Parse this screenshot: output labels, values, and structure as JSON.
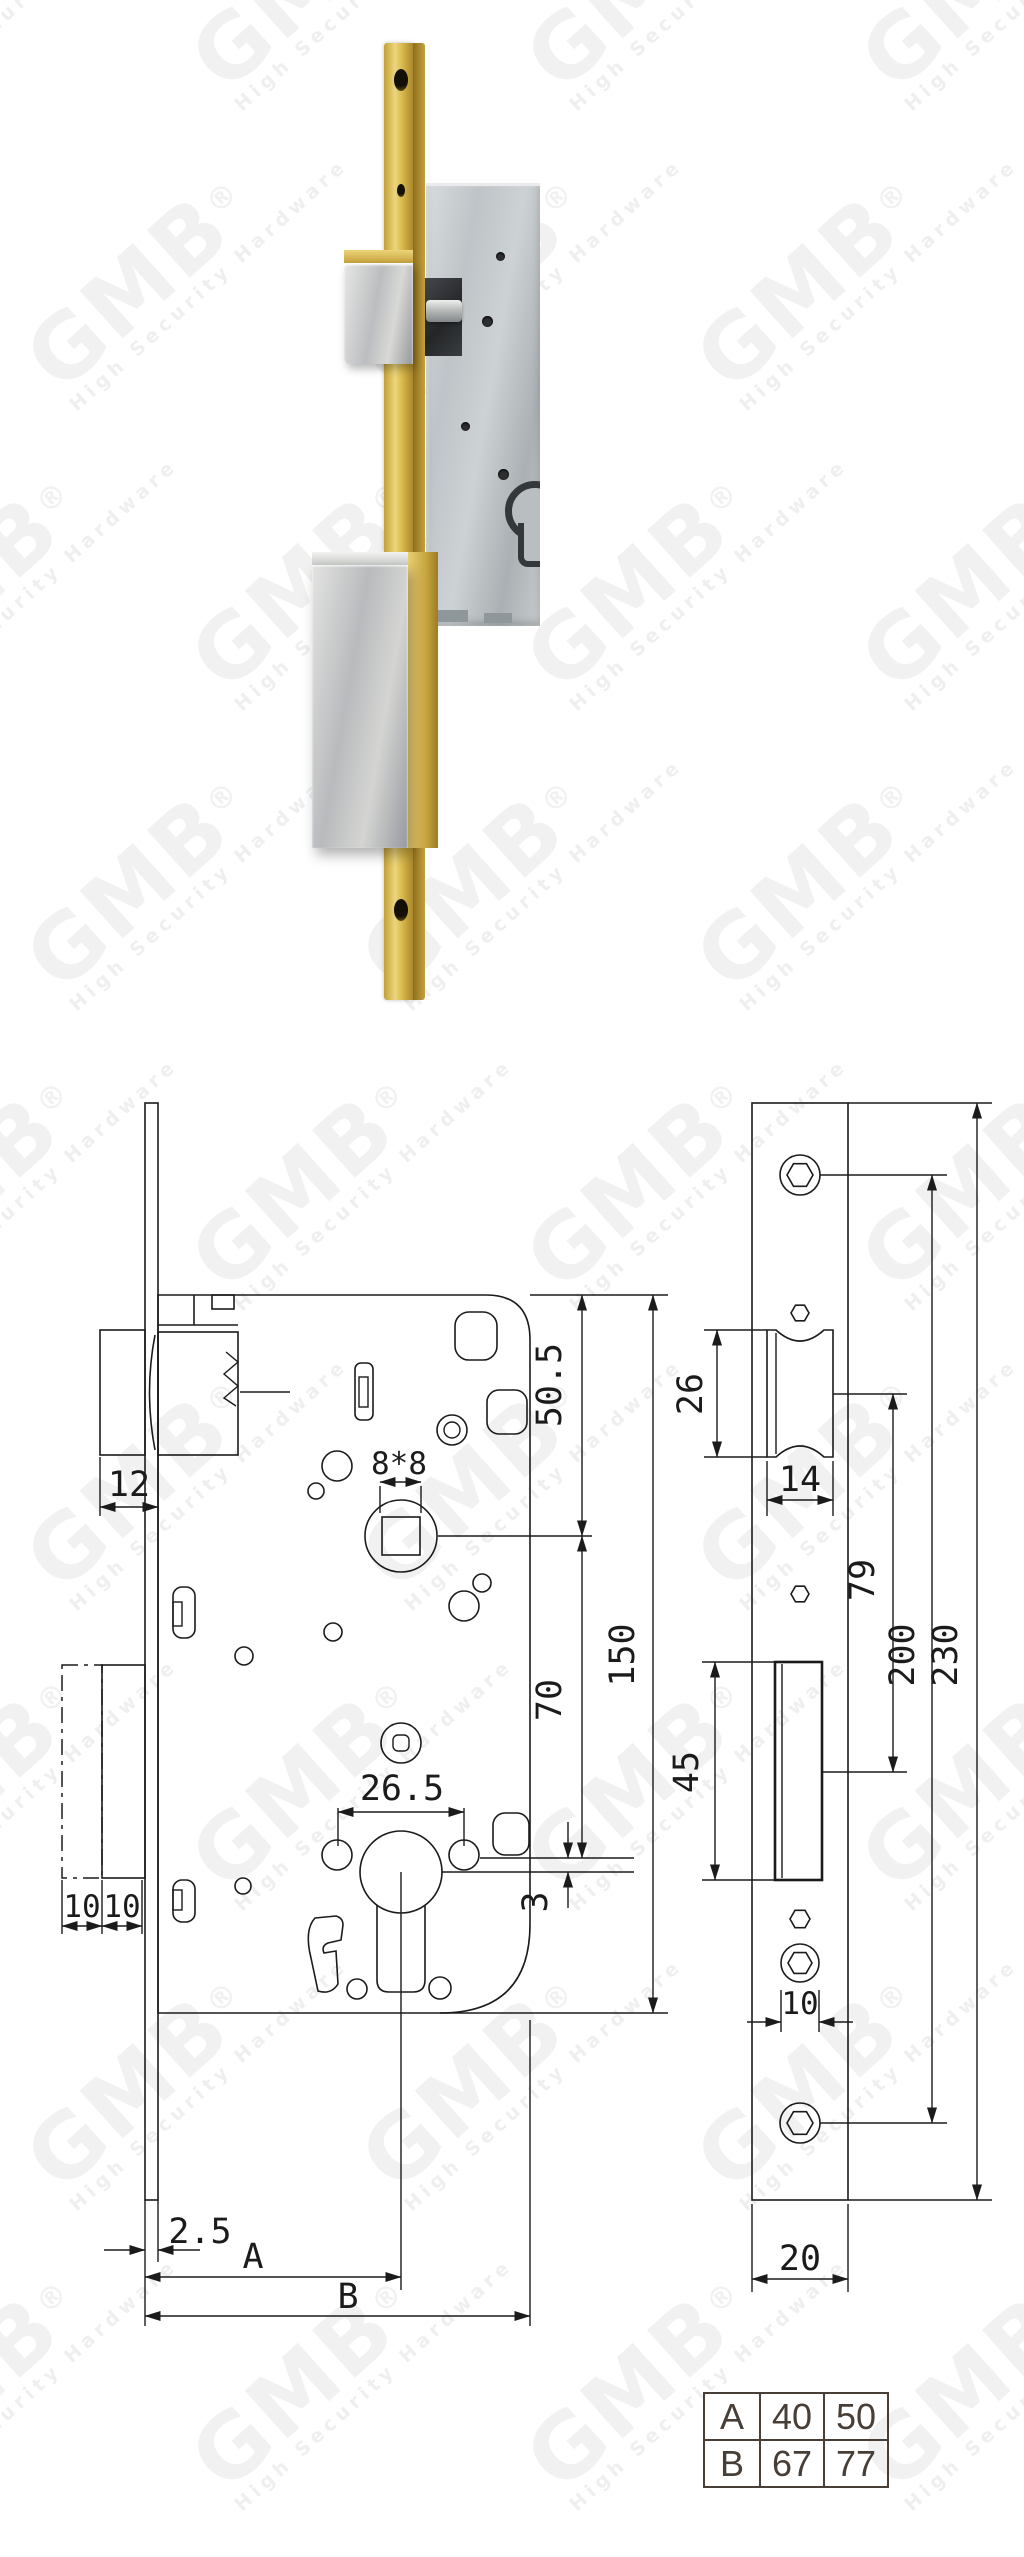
{
  "watermark": {
    "logo": "GMB",
    "registered": "®",
    "tagline": "High Security Hardware"
  },
  "colors": {
    "brass": "#d8b94d",
    "steel": "#c4c9cc",
    "silver": "#cfd1ce",
    "line": "#1b1b1b",
    "table_ink": "#473f37"
  },
  "left_view": {
    "dims": {
      "d12": "12",
      "d8x8": "8*8",
      "d50_5": "50.5",
      "d70": "70",
      "d150": "150",
      "d26_5": "26.5",
      "d3": "3",
      "d10a": "10",
      "d10b": "10",
      "d2_5": "2.5",
      "dA": "A",
      "dB": "B"
    }
  },
  "right_view": {
    "dims": {
      "d26": "26",
      "d14": "14",
      "d45": "45",
      "d79": "79",
      "d200": "200",
      "d230": "230",
      "d10": "10",
      "d20": "20"
    }
  },
  "spec_table": {
    "rows": [
      {
        "label": "A",
        "v1": "40",
        "v2": "50"
      },
      {
        "label": "B",
        "v1": "67",
        "v2": "77"
      }
    ]
  }
}
